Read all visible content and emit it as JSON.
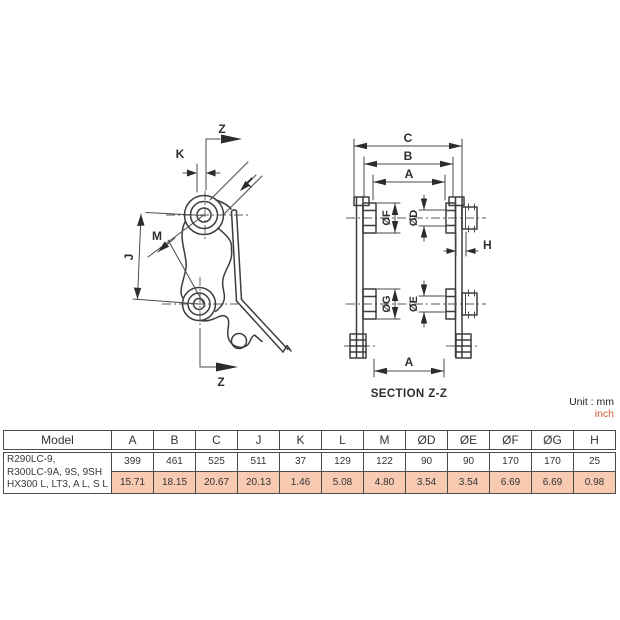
{
  "unit_label": {
    "line1": "Unit : mm",
    "line2": "inch"
  },
  "section_label": "SECTION Z-Z",
  "left_view": {
    "labels": {
      "z_top": "Z",
      "k": "K",
      "l": "L",
      "m": "M",
      "j": "J",
      "z_bottom": "Z"
    }
  },
  "right_view": {
    "labels": {
      "c": "C",
      "b": "B",
      "a_top": "A",
      "f": "ØF",
      "d": "ØD",
      "g": "ØG",
      "e": "ØE",
      "h": "H",
      "a_bottom": "A"
    }
  },
  "table": {
    "headers": [
      "Model",
      "A",
      "B",
      "C",
      "J",
      "K",
      "L",
      "M",
      "ØD",
      "ØE",
      "ØF",
      "ØG",
      "H"
    ],
    "model_lines": [
      "R290LC-9,",
      "R300LC-9A, 9S, 9SH",
      "HX300 L, LT3, A L, S L"
    ],
    "mm_row": [
      "399",
      "461",
      "525",
      "511",
      "37",
      "129",
      "122",
      "90",
      "90",
      "170",
      "170",
      "25"
    ],
    "inch_row": [
      "15.71",
      "18.15",
      "20.67",
      "20.13",
      "1.46",
      "5.08",
      "4.80",
      "3.54",
      "3.54",
      "6.69",
      "6.69",
      "0.98"
    ]
  },
  "colors": {
    "accent_pink": "#f8cab1",
    "accent_red": "#cf5a33",
    "line": "#3d3d3d"
  }
}
